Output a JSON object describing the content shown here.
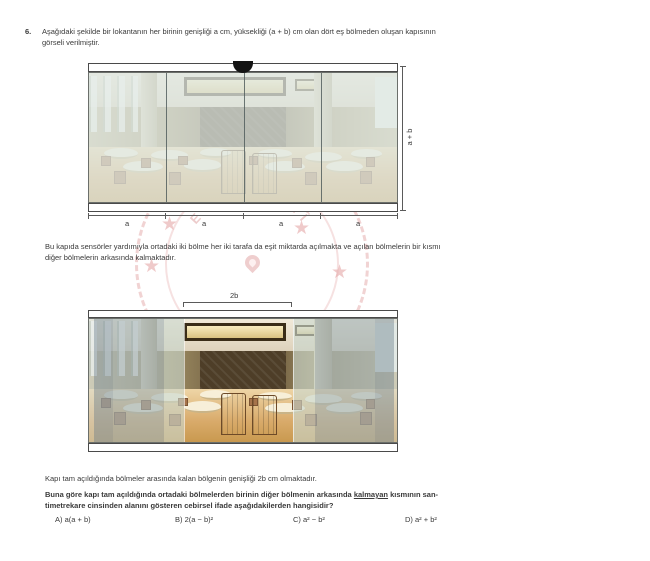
{
  "question": {
    "number": "6.",
    "intro_lines": [
      "Aşağıdaki şekilde bir lokantanın her birinin genişliği a cm, yüksekliği (a + b) cm olan dört eş bölmeden oluşan kapısının",
      "görseli verilmiştir."
    ],
    "sensor_lines": [
      "Bu kapıda sensörler yardımıyla ortadaki iki bölme her iki tarafa da eşit miktarda açılmakta ve açılan bölmelerin bir kısmı",
      "diğer bölmelerin arkasında kalmaktadır."
    ],
    "gap_line": "Kapı tam açıldığında bölmeler arasında kalan bölgenin genişliği 2b cm olmaktadır.",
    "final_before": "Buna göre kapı tam açıldığında ortadaki bölmelerden birinin diğer bölmenin arkasında ",
    "final_underlined": "kalmayan",
    "final_after": " kısmının san-",
    "final_line2": "timetrekare cinsinden alanını gösteren cebirsel ifade aşağıdakilerden hangisidir?",
    "options": [
      {
        "label": "A)",
        "expr": "a(a + b)"
      },
      {
        "label": "B)",
        "expr": "2(a − b)²"
      },
      {
        "label": "C)",
        "expr": "a² − b²"
      },
      {
        "label": "D)",
        "expr": "a² + b²"
      }
    ]
  },
  "figure1": {
    "width_labels": [
      "a",
      "a",
      "a",
      "a"
    ],
    "height_label": "a + b"
  },
  "figure2": {
    "gap_label": "2b"
  },
  "watermark": {
    "arc_letters": [
      "E",
      "T",
      "İ",
      " ",
      "M",
      "İ",
      "L",
      "L",
      "Î"
    ]
  },
  "colors": {
    "text": "#3a3a3a",
    "watermark_red": "#d06e6e",
    "closed_door_wash": "#dfe8e4",
    "glass_overlay_gray": "#748994",
    "sensor_black": "#141414",
    "floor_tan": "#d9ab6b"
  }
}
